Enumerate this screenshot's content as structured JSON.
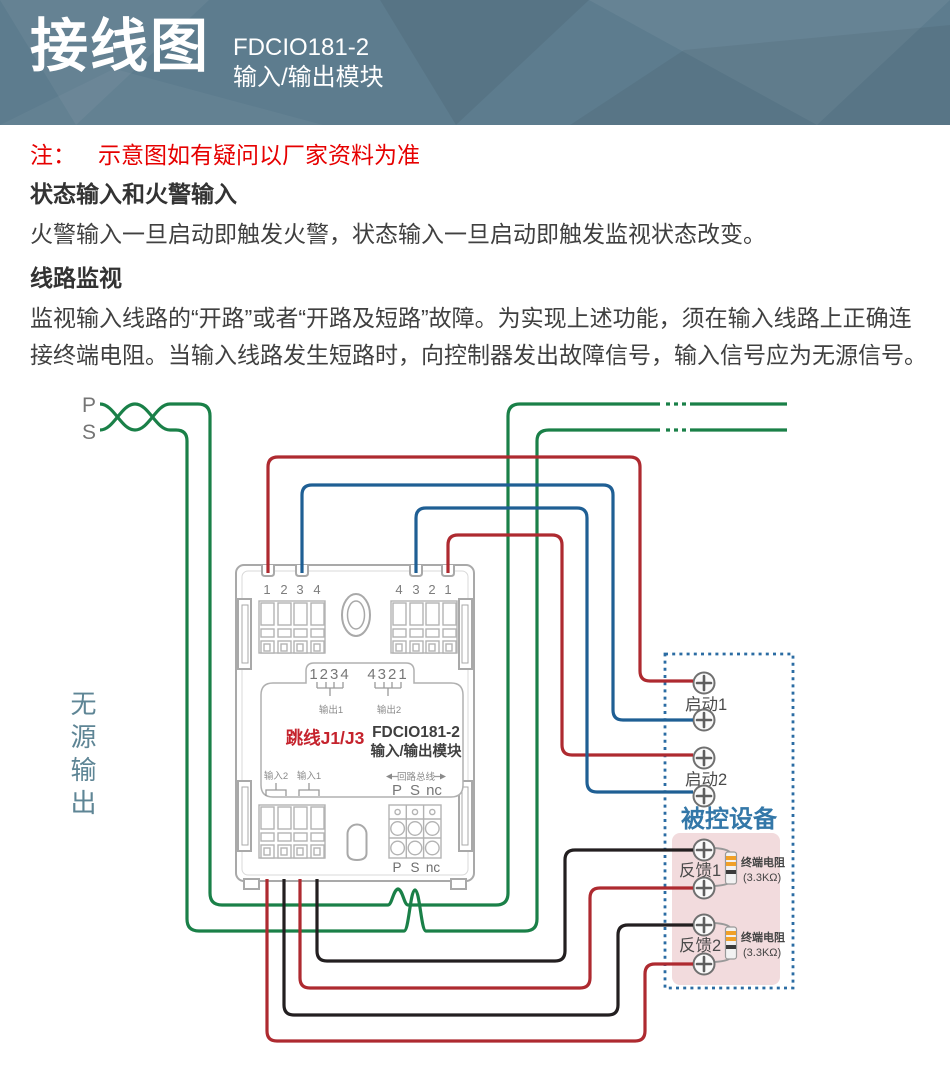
{
  "header": {
    "title": "接线图",
    "model": "FDCIO181-2",
    "model_type": "输入/输出模块"
  },
  "note": {
    "prefix": "注：",
    "text": "示意图如有疑问以厂家资料为准"
  },
  "sections": {
    "s1_heading": "状态输入和火警输入",
    "s1_body": "火警输入一旦启动即触发火警，状态输入一旦启动即触发监视状态改变。",
    "s2_heading": "线路监视",
    "s2_body": "监视输入线路的“开路”或者“开路及短路”故障。为实现上述功能，须在输入线路上正确连接终端电阻。当输入线路发生短路时，向控制器发出故障信号，输入信号应为无源信号。"
  },
  "diagram": {
    "p": "P",
    "s": "S",
    "passive_output": "无源输出"
  },
  "module": {
    "pins_left": [
      "1",
      "2",
      "3",
      "4"
    ],
    "pins_right": [
      "4",
      "3",
      "2",
      "1"
    ],
    "jumper_row1": "1234",
    "jumper_row2": "4321",
    "out1": "输出1",
    "out2": "输出2",
    "jumper": "跳线J1/J3",
    "model": "FDCIO181-2",
    "model_type": "输入/输出模块",
    "in2": "输入2",
    "in1": "输入1",
    "bus": "回路总线",
    "p": "P",
    "s": "S",
    "nc": "nc"
  },
  "device": {
    "start1": "启动1",
    "start2": "启动2",
    "name": "被控设备",
    "fb1": "反馈1",
    "fb2": "反馈2",
    "resistor": "终端电阻",
    "resistor_value": "(3.3KΩ)"
  },
  "colors": {
    "header_bg": "#5d7c8e",
    "note_red": "#e60000",
    "wire_green": "#1a8048",
    "wire_red": "#ae2a30",
    "wire_blue": "#1f5f94",
    "wire_black": "#231f20",
    "module_gray": "#a9a9a9",
    "module_text": "#8a8a8a",
    "jumper_red": "#c5232d",
    "device_blue": "#3377a8",
    "dashed_blue": "#2b6ca3",
    "device_pink": "#f2dbdd",
    "resistor_band": "#f0a028",
    "passive_label": "#5e8595"
  }
}
